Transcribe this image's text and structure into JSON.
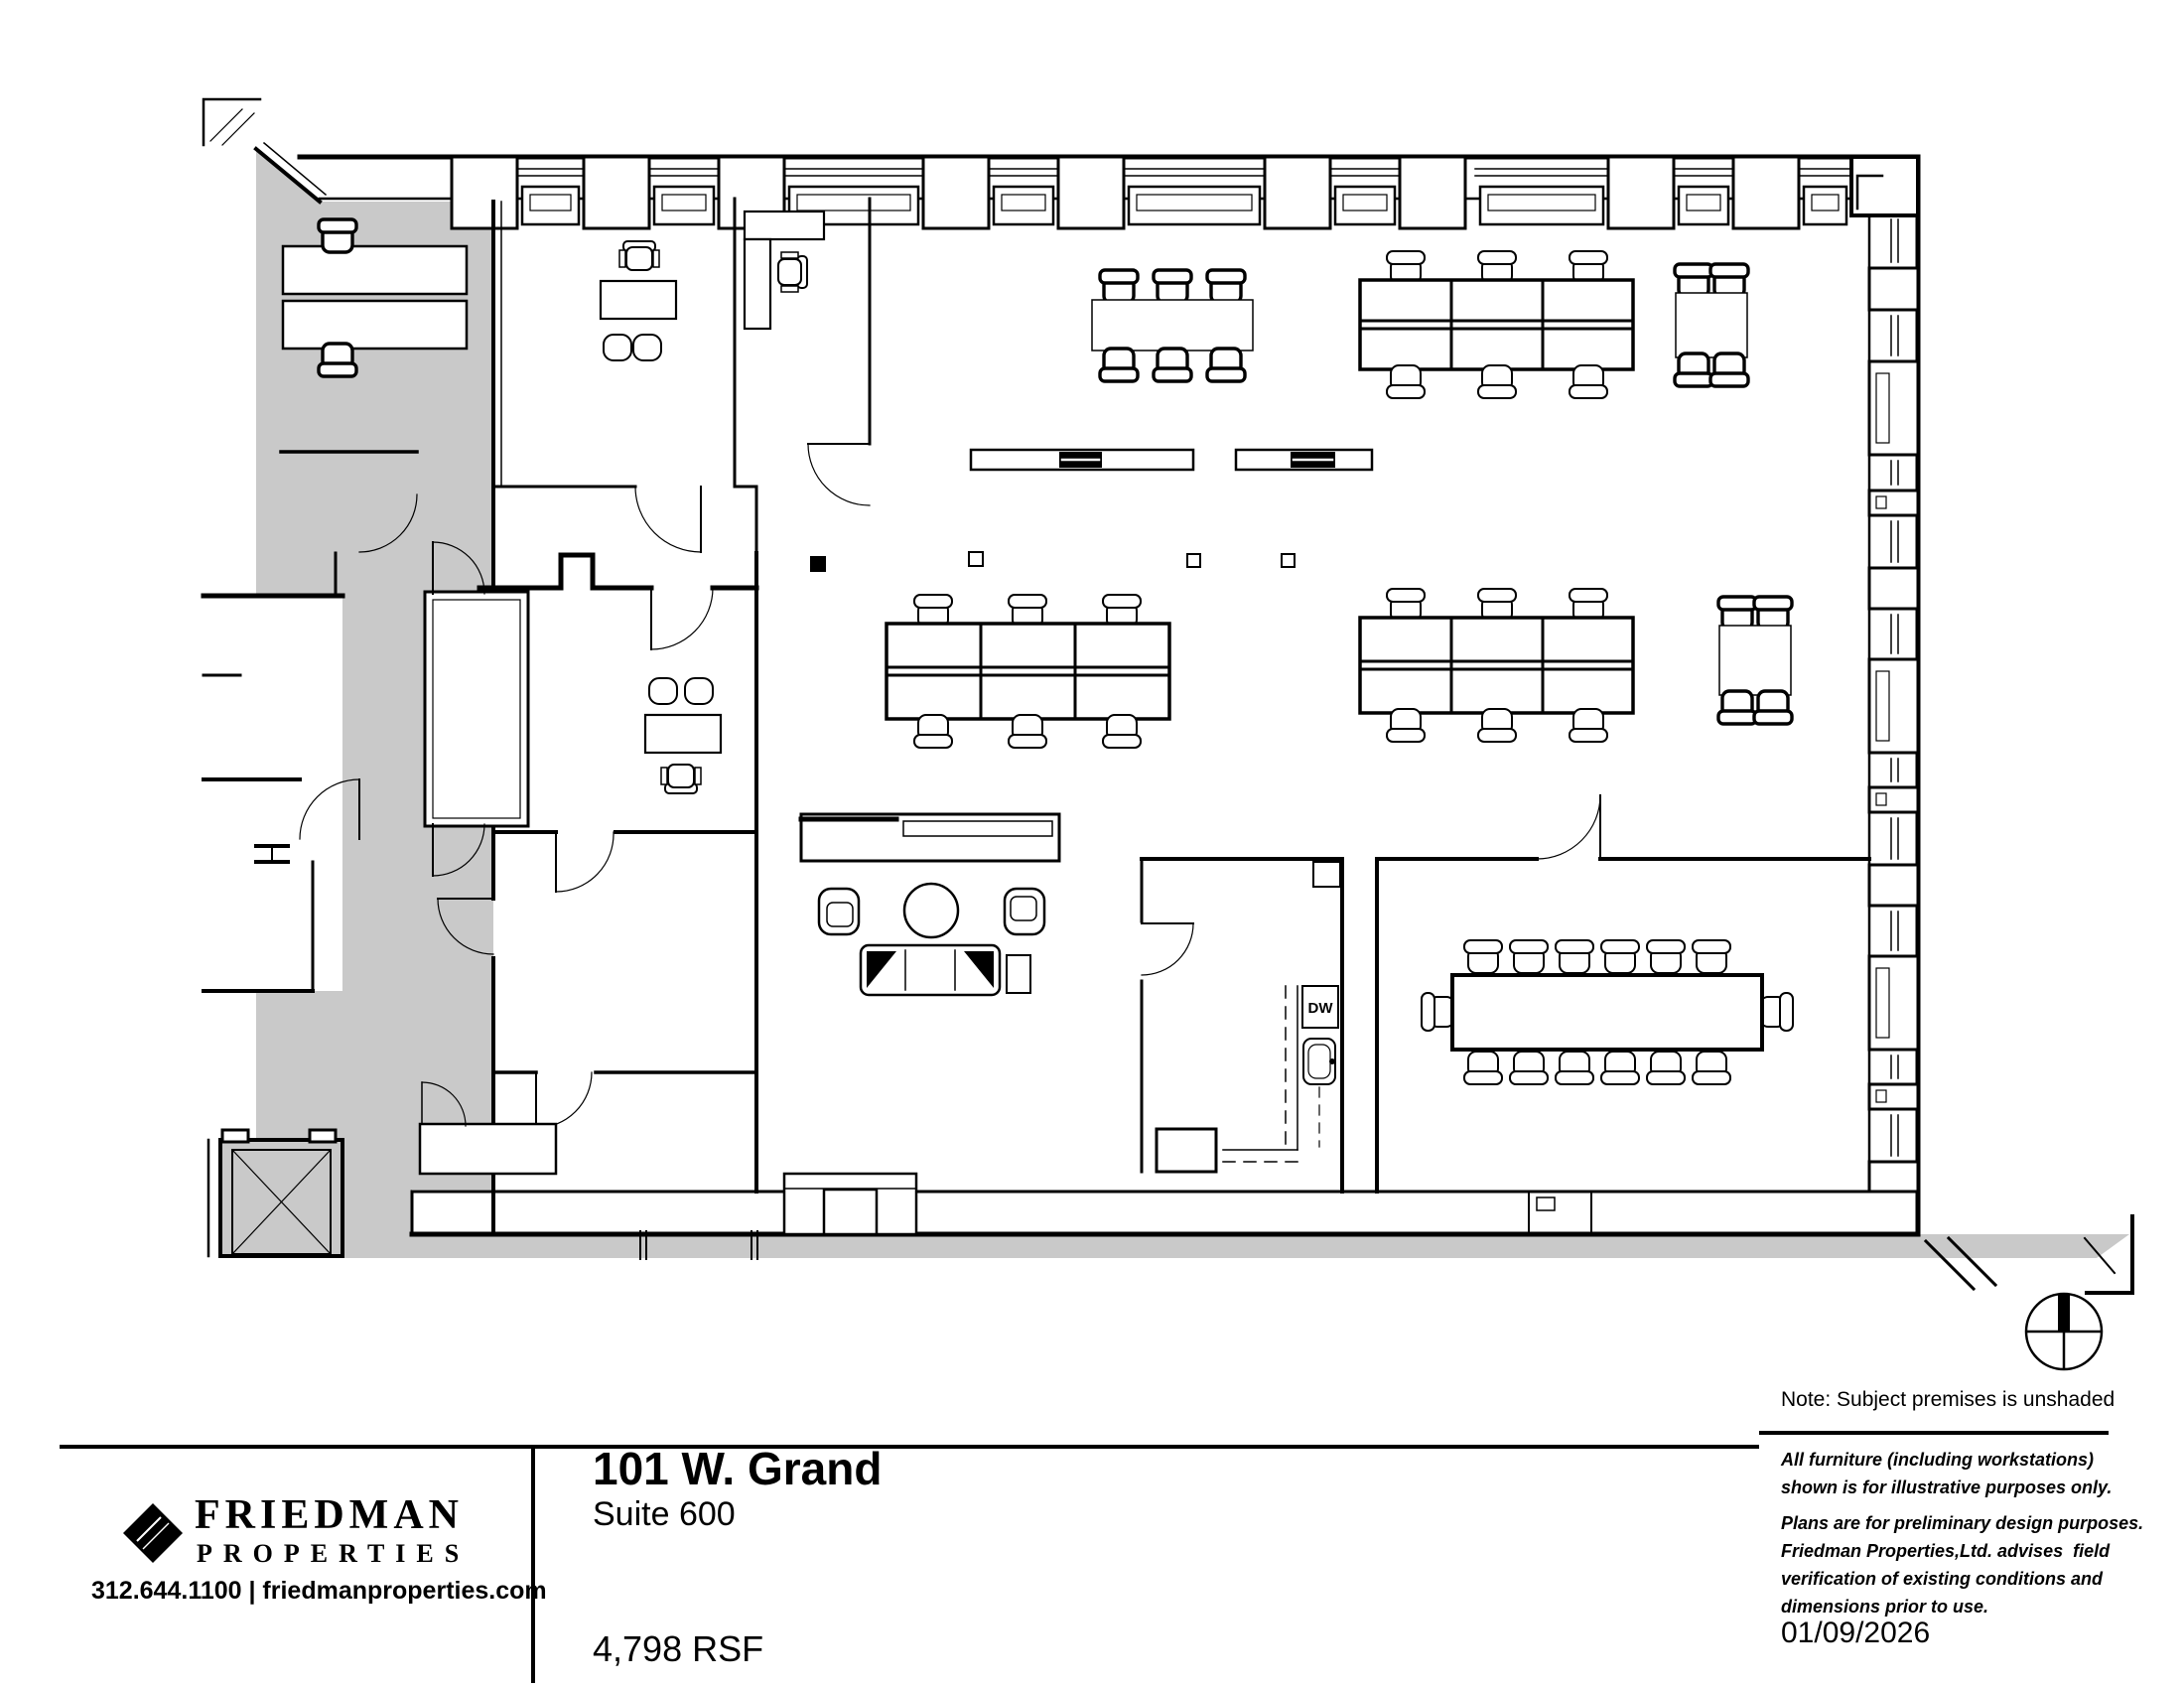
{
  "colors": {
    "shaded_area": "#c9c9c9",
    "linework": "#000000",
    "paper": "#ffffff"
  },
  "plan": {
    "labels": {
      "dishwasher": "DW"
    }
  },
  "footer": {
    "logo": {
      "brand_line1": "FRIEDMAN",
      "brand_line2": "PROPERTIES",
      "contact": "312.644.1100 | friedmanproperties.com"
    },
    "title": {
      "building": "101 W. Grand",
      "suite": "Suite 600",
      "area": "4,798 RSF"
    },
    "notes": {
      "shading_note": "Note: Subject premises is unshaded",
      "disclaimer1": [
        "All furniture (including workstations)",
        "shown is for illustrative purposes only."
      ],
      "disclaimer2": [
        "Plans are for preliminary design purposes.",
        "Friedman Properties,Ltd. advises  field",
        "verification of existing conditions and",
        "dimensions prior to use."
      ],
      "date": "01/09/2026"
    }
  }
}
